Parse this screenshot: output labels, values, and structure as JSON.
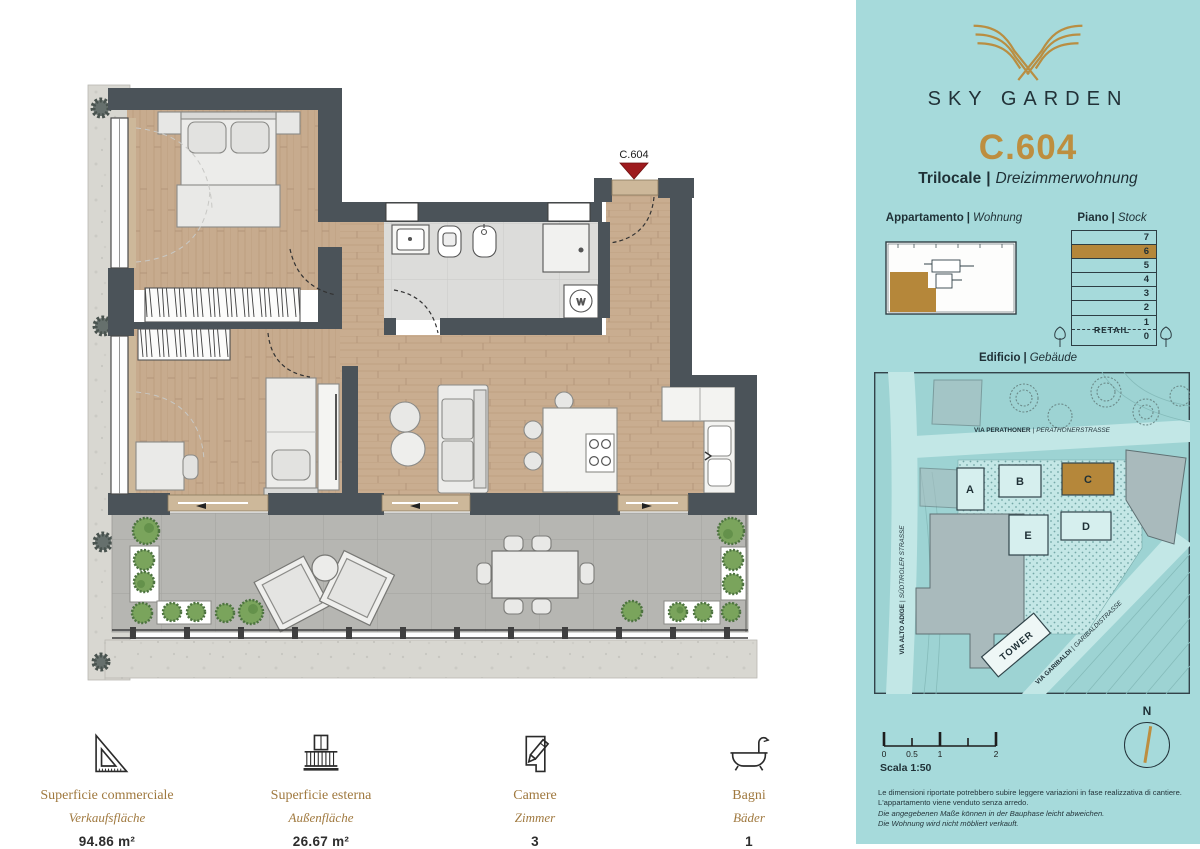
{
  "colors": {
    "teal": "#a6dadb",
    "gold": "#bd8e3f",
    "wall_gray": "#4b5359",
    "marker_red": "#9e1b1e",
    "wood": "#c9ad90",
    "terrace": "#b6b6b2"
  },
  "plan": {
    "unit_marker": "C.604",
    "washer_label": "W"
  },
  "stats": {
    "items": [
      {
        "label_it": "Superficie commerciale",
        "label_de": "Verkaufsfläche",
        "value": "94.86 m²"
      },
      {
        "label_it": "Superficie esterna",
        "label_de": "Außenfläche",
        "value": "26.67 m²"
      },
      {
        "label_it": "Camere",
        "label_de": "Zimmer",
        "value": "3"
      },
      {
        "label_it": "Bagni",
        "label_de": "Bäder",
        "value": "1"
      }
    ]
  },
  "sidebar": {
    "brand": "SKY GARDEN",
    "unit_code": "C.604",
    "divider": "|",
    "unit_type_it": "Trilocale",
    "unit_type_de": "Dreizimmerwohnung",
    "headings": {
      "apartment_it": "Appartamento",
      "apartment_de": "Wohnung",
      "floor_it": "Piano",
      "floor_de": "Stock",
      "building_it": "Edificio",
      "building_de": "Gebäude"
    },
    "floor_stack": {
      "floors": [
        "7",
        "6",
        "5",
        "4",
        "3",
        "2",
        "1",
        "0"
      ],
      "highlighted_floor": "6",
      "retail_label": "RETAIL"
    },
    "site_plan": {
      "streets": [
        {
          "it": "VIA PERATHONER",
          "de": "PERATHONERSTRASSE"
        },
        {
          "it": "VIA ALTO ADIGE",
          "de": "SÜDTIROLER STRASSE"
        },
        {
          "it": "VIA GARIBALDI",
          "de": "GARIBALDISTRASSE"
        }
      ],
      "blocks": [
        "A",
        "B",
        "C",
        "D",
        "E"
      ],
      "highlighted_block": "C",
      "tower_label": "TOWER"
    },
    "scale": {
      "ticks": [
        "0",
        "0.5",
        "1",
        "2"
      ],
      "label": "Scala 1:50"
    },
    "compass_label": "N",
    "disclaimer": {
      "l1": "Le dimensioni riportate potrebbero subire leggere variazioni in fase realizzativa di cantiere.",
      "l2": "L'appartamento viene venduto senza arredo.",
      "l3": "Die angegebenen Maße können in der Bauphase leicht abweichen.",
      "l4": "Die Wohnung wird nicht möbliert verkauft."
    }
  }
}
